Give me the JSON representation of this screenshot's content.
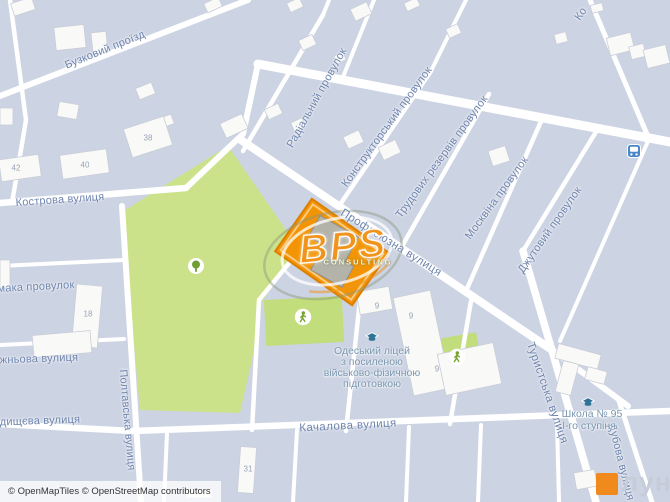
{
  "streets": [
    "Бузковий проїзд",
    "Кострова вулиця",
    "Радіальний провулок",
    "Конструкторський провулок",
    "Трудових резервів провулок",
    "Москвіна провулок",
    "Джутовий провулок",
    "Ко",
    "Профсоюзна вулиця",
    "Туристська вулиця",
    "Дубова вулиця",
    "Полтавська вулиця",
    "Качалова вулиця",
    "мака провулок",
    "жньова вулиця",
    "дищєва вулиця"
  ],
  "house_numbers": [
    "42",
    "40",
    "38",
    "18",
    "31",
    "9",
    "9",
    "9"
  ],
  "pois": {
    "lyceum": {
      "lines": [
        "Одеський ліцей",
        "з посиленою",
        "військово-фізичною",
        "підготовкою"
      ]
    },
    "school": {
      "lines": [
        "Школа № 95",
        "І-го ступіня"
      ]
    }
  },
  "watermark": {
    "title": "BPS",
    "subtitle": "CONSULTING"
  },
  "logo": {
    "text": "лун"
  },
  "attribution": {
    "text": "© OpenMapTiles © OpenStreetMap contributors"
  },
  "icons": [
    "tree-icon",
    "pedestrian-icon",
    "pedestrian-icon",
    "school-icon",
    "school-icon",
    "bus-stop-icon"
  ],
  "colors": {
    "background": "#ccd3e3",
    "road": "#ffffff",
    "park": "#cbe28a",
    "sports_field": "#c2dd7b",
    "highlight_parcel": "#f29404",
    "brand_orange": "#f08a1d",
    "label_blue": "#6e84ad"
  }
}
